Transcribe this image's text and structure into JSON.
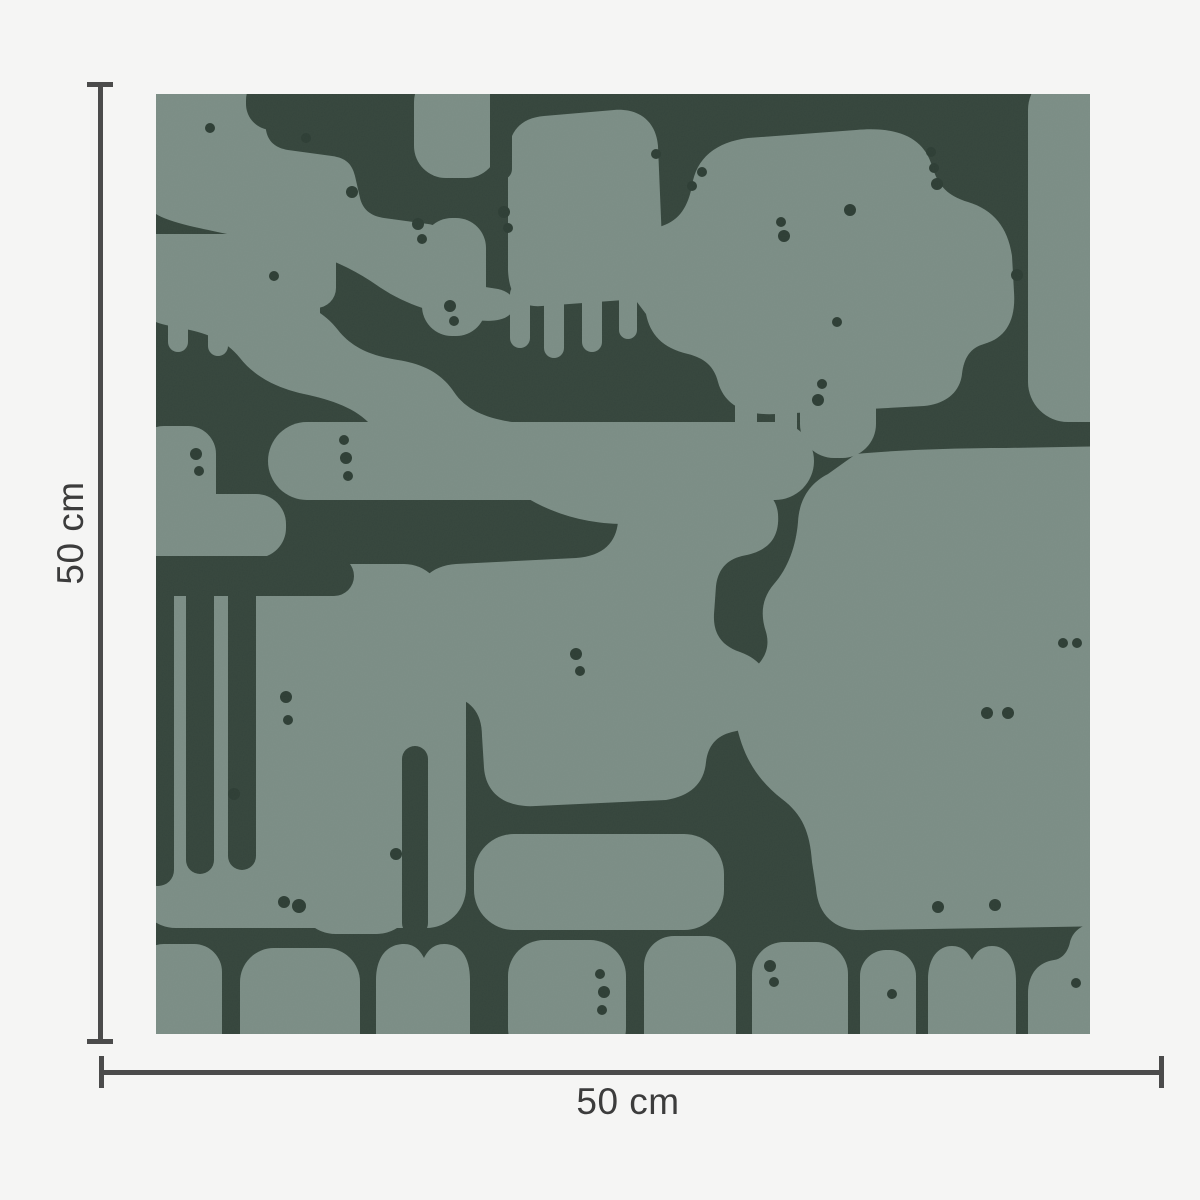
{
  "figure": {
    "type": "product-dimension-diagram",
    "subject": "abstract organic-pattern wallpaper swatch"
  },
  "dimensions": {
    "vertical": {
      "label": "50 cm"
    },
    "horizontal": {
      "label": "50 cm"
    }
  },
  "colors": {
    "page_bg": "#F5F5F4",
    "line": "#4B4B4B",
    "text": "#3C3C3C",
    "pattern_bg": "#35453C",
    "pattern_fg": "#7B8D85",
    "dot": "#2E3E35"
  }
}
